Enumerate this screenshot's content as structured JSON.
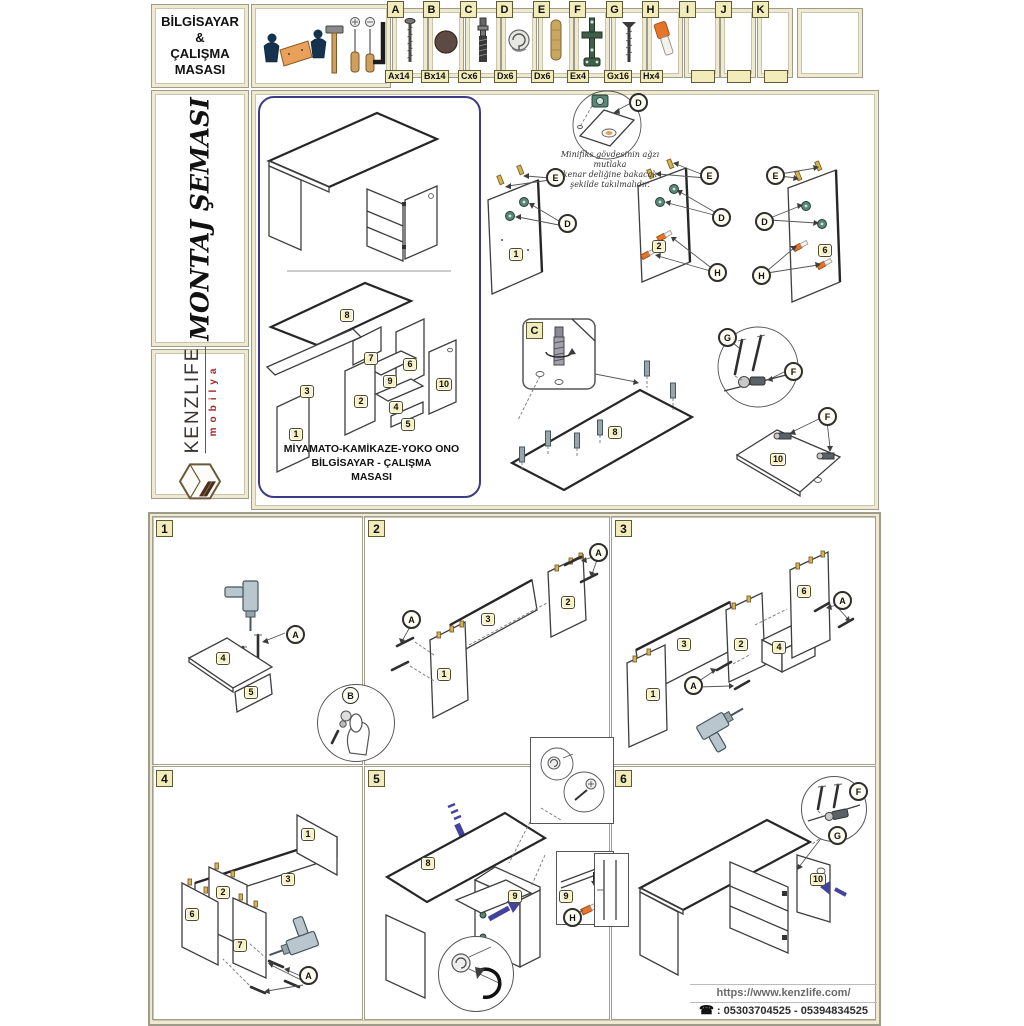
{
  "header": {
    "title_line1": "BİLGİSAYAR",
    "title_line2": "&",
    "title_line3": "ÇALIŞMA",
    "title_line4": "MASASI"
  },
  "sidebar": {
    "montaj_title": "MONTAJ ŞEMASI",
    "brand_name": "KENZLIFE",
    "brand_sub": "mobilya"
  },
  "hardware": {
    "items": [
      {
        "letter": "A",
        "count": "Ax14",
        "name": "chipboard-screw"
      },
      {
        "letter": "B",
        "count": "Bx14",
        "name": "cover-cap"
      },
      {
        "letter": "C",
        "count": "Cx6",
        "name": "cam-bolt"
      },
      {
        "letter": "D",
        "count": "Dx6",
        "name": "minifix-cam-housing"
      },
      {
        "letter": "E",
        "count": "Dx6",
        "name": "wooden-dowel"
      },
      {
        "letter": "F",
        "count": "Ex4",
        "name": "cabinet-hinge"
      },
      {
        "letter": "G",
        "count": "Gx16",
        "name": "hinge-screw"
      },
      {
        "letter": "H",
        "count": "Hx4",
        "name": "plastic-plug"
      },
      {
        "letter": "I",
        "count": "",
        "name": "empty"
      },
      {
        "letter": "J",
        "count": "",
        "name": "empty"
      },
      {
        "letter": "K",
        "count": "",
        "name": "empty"
      }
    ]
  },
  "diagram": {
    "note_line1": "Minifiks gövdesinin ağzı mutlaka",
    "note_line2": "kenar deliğine bakacak",
    "note_line3": "şekilde takılmalıdır.",
    "caption_line1": "MİYAMATO-KAMİKAZE-YOKO ONO",
    "caption_line2": "BİLGİSAYAR - ÇALIŞMA",
    "caption_line3": "MASASI"
  },
  "parts": {
    "p1": "1",
    "p2": "2",
    "p3": "3",
    "p4": "4",
    "p5": "5",
    "p6": "6",
    "p7": "7",
    "p8": "8",
    "p9": "9",
    "p10": "10"
  },
  "letters": {
    "A": "A",
    "B": "B",
    "C": "C",
    "D": "D",
    "E": "E",
    "F": "F",
    "G": "G",
    "H": "H"
  },
  "steps": {
    "s1": "1",
    "s2": "2",
    "s3": "3",
    "s4": "4",
    "s5": "5",
    "s6": "6"
  },
  "footer": {
    "url": "https://www.kenzlife.com/",
    "phone_glyph": "☎",
    "phones": ": 05303704525 - 05394834525"
  }
}
